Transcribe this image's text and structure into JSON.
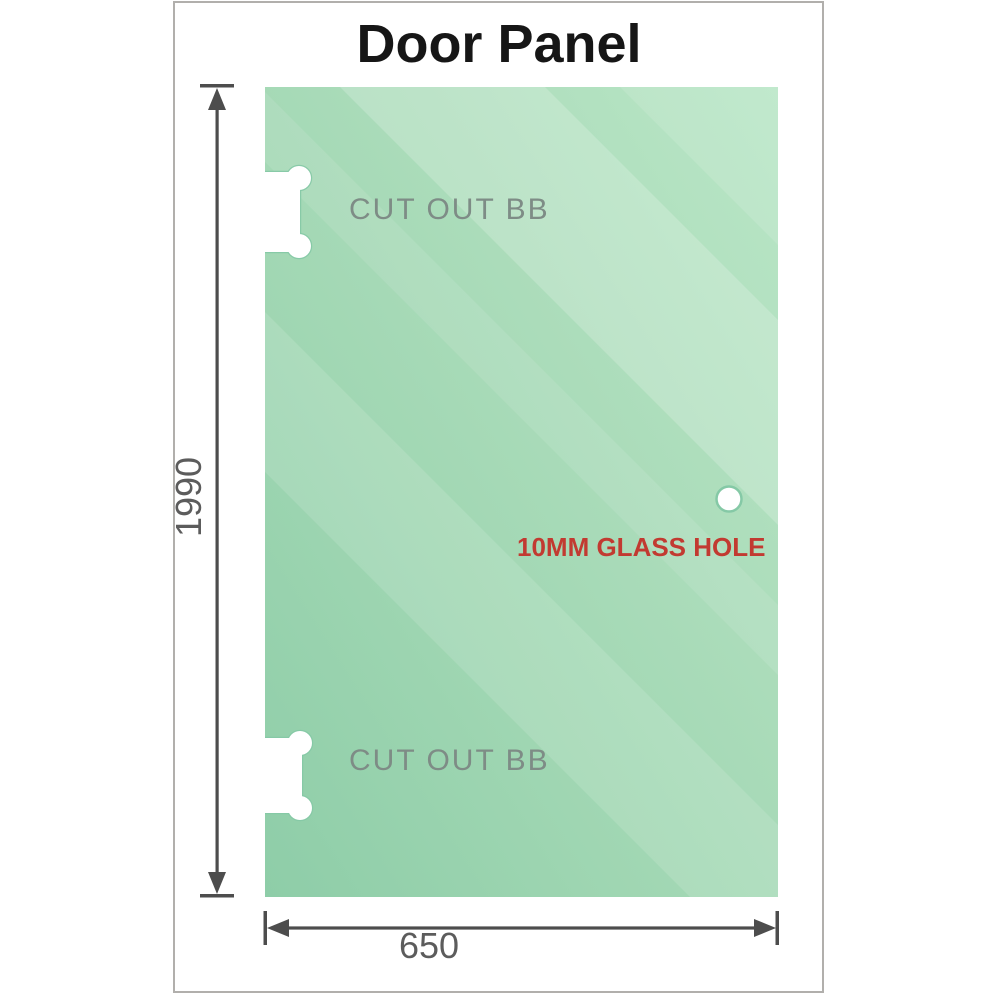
{
  "title": "Door Panel",
  "panel": {
    "type": "glass-door-panel",
    "height_label": "1990",
    "width_label": "650",
    "features": [
      "cut-out-bb-top",
      "cut-out-bb-bottom",
      "10mm-glass-hole"
    ]
  },
  "labels": {
    "cutout_top": "CUT OUT BB",
    "cutout_bottom": "CUT OUT BB",
    "glass_hole": "10MM GLASS HOLE"
  },
  "dimensions": {
    "height": "1990",
    "width": "650"
  },
  "colors": {
    "glass_base": "#a0d6b4",
    "glass_light": "#bde8cc",
    "glass_dark": "#8ecda8",
    "cutout_edge": "#85c9a6",
    "dimension_lines": "#4d4d4d",
    "dimension_text": "#5c5c5c",
    "cutout_label_gray": "#7e8c86",
    "hole_label_red": "#c23a31",
    "frame_border": "#b1afac",
    "title_text": "#161616"
  }
}
